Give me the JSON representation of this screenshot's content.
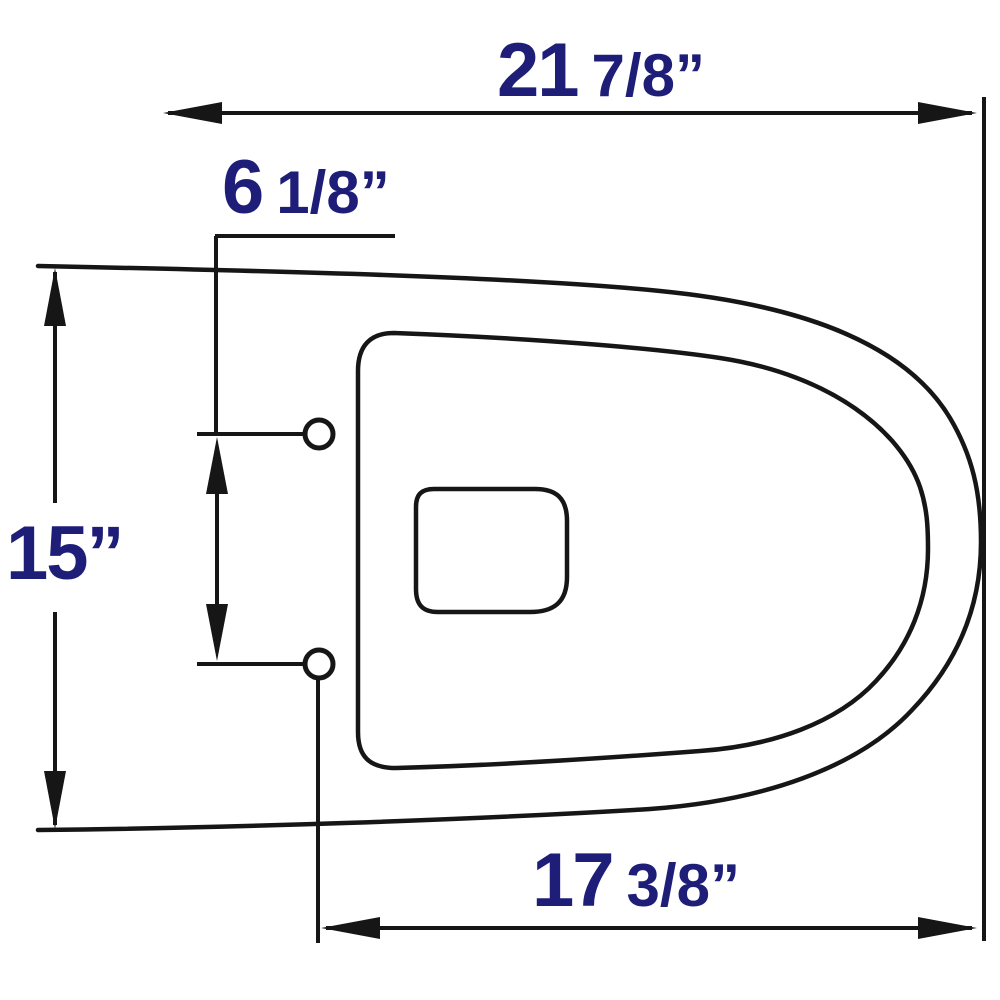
{
  "labels": {
    "top_width": {
      "whole": "21",
      "fraction": "7/8”"
    },
    "bolt_offset": {
      "whole": "6",
      "fraction": "1/8”"
    },
    "height": {
      "whole": "15”",
      "fraction": ""
    },
    "bottom_width": {
      "whole": "17",
      "fraction": "3/8”"
    }
  },
  "colors": {
    "line": "#161616",
    "label": "#1e1e78",
    "background": "#ffffff"
  }
}
